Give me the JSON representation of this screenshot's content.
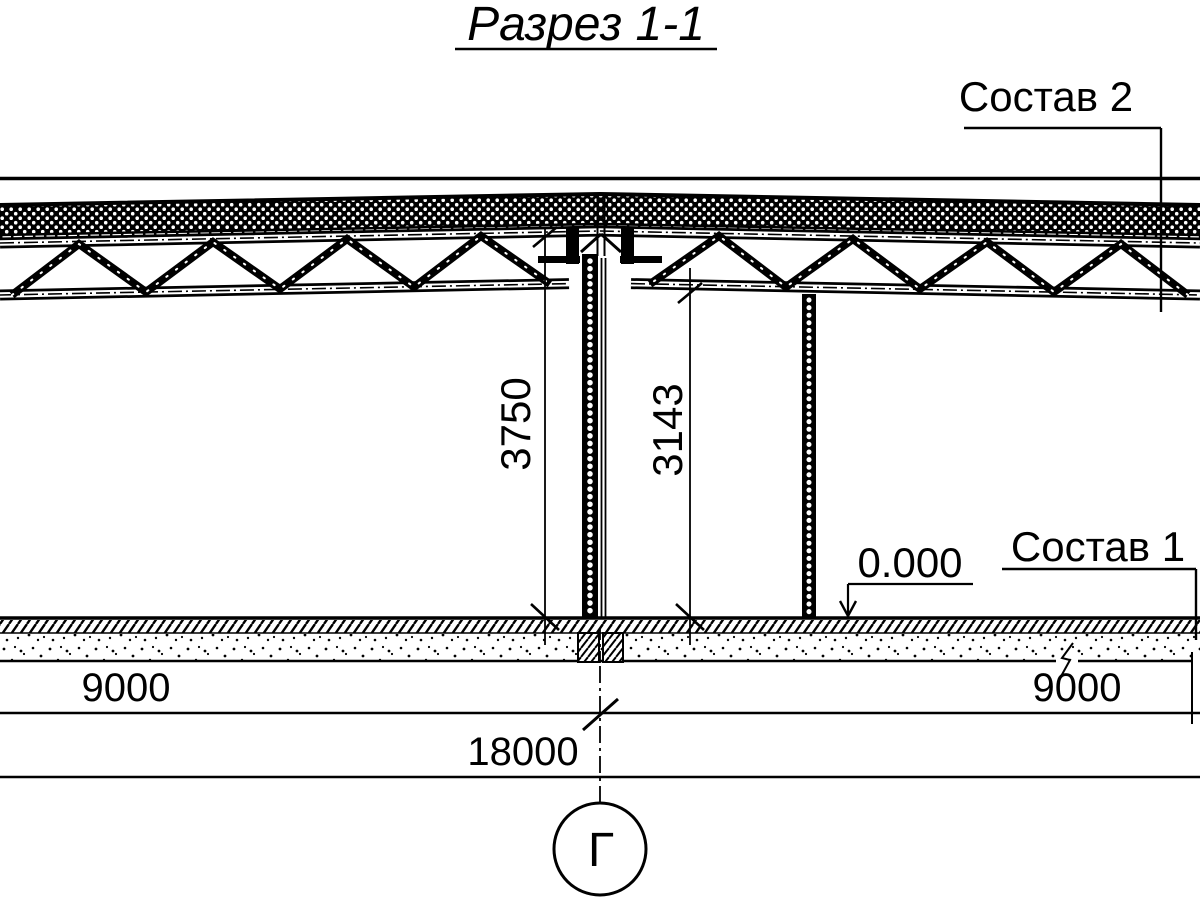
{
  "drawing": {
    "title": "Разрез 1-1",
    "labels": {
      "composition2": "Состав 2",
      "composition1": "Состав 1",
      "elevation": "0.000",
      "axis_letter": "Г"
    },
    "dimensions": {
      "floor_to_roof_top": "3750",
      "floor_to_truss_bottom": "3143",
      "span_left": "9000",
      "span_right": "9000",
      "span_total": "18000"
    },
    "colors": {
      "ink": "#000000",
      "paper": "#ffffff"
    }
  }
}
